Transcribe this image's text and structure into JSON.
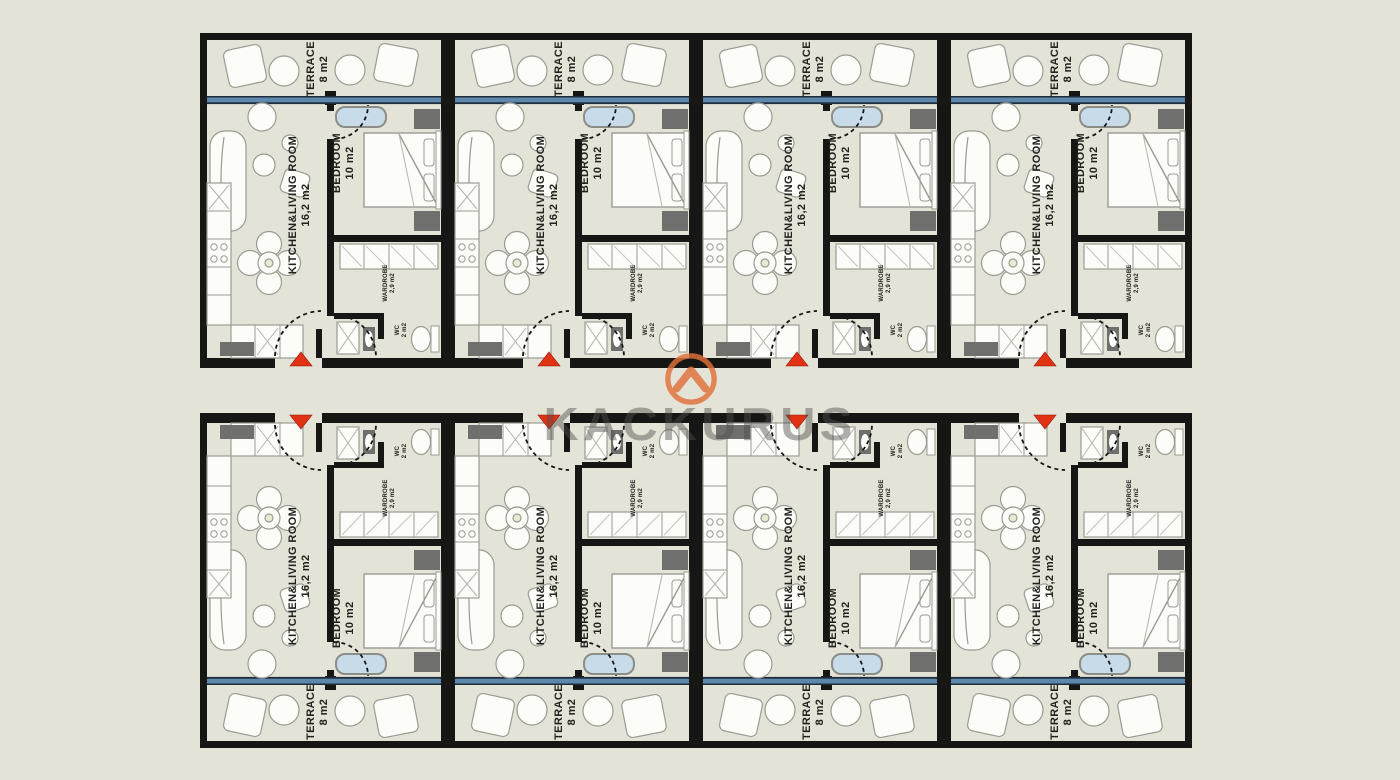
{
  "scene": {
    "type": "architectural-floor-plan",
    "description": "Residential floor plan: two rows of four identical studio units mirrored across a central corridor",
    "rows": 2,
    "units_per_row": 4
  },
  "watermark": {
    "brand": "KACKURUS",
    "logo_icon": "chevron-circle-icon",
    "logo_color": "#e1713c",
    "text_color_rgba": "rgba(78,78,76,0.45)"
  },
  "room_labels": {
    "terrace": {
      "name": "TERRACE",
      "area": "8 m2"
    },
    "living": {
      "name": "KITCHEN&LIVING ROOM",
      "area": "16,2 m2"
    },
    "bedroom": {
      "name": "BEDROOM",
      "area": "10 m2"
    },
    "wardrobe": {
      "name": "WARDROBE",
      "area": "2,9 m2"
    },
    "wc": {
      "name": "WC",
      "area": "2 m2"
    }
  },
  "units": [
    {
      "id": "top-unit-1",
      "row": "top",
      "index": 0
    },
    {
      "id": "top-unit-2",
      "row": "top",
      "index": 1
    },
    {
      "id": "top-unit-3",
      "row": "top",
      "index": 2
    },
    {
      "id": "top-unit-4",
      "row": "top",
      "index": 3
    },
    {
      "id": "bottom-unit-1",
      "row": "bottom",
      "index": 0
    },
    {
      "id": "bottom-unit-2",
      "row": "bottom",
      "index": 1
    },
    {
      "id": "bottom-unit-3",
      "row": "bottom",
      "index": 2
    },
    {
      "id": "bottom-unit-4",
      "row": "bottom",
      "index": 3
    }
  ],
  "entry_marker": {
    "shape": "triangle",
    "color": "#e13214",
    "meaning": "unit entrance from corridor"
  },
  "colors": {
    "background": "#e4e3d7",
    "walls": "#161614",
    "glazing_blue": "#5d87ab",
    "glazing_edge": "#1e2c3a",
    "furniture_fill": "#fcfcf8",
    "furniture_stroke": "#9b9b94",
    "dark_fixture": "#6f6f6d",
    "bathtub_fill": "#c7dbe9",
    "entry_red": "#e13214",
    "logo_orange": "#e1713c"
  }
}
